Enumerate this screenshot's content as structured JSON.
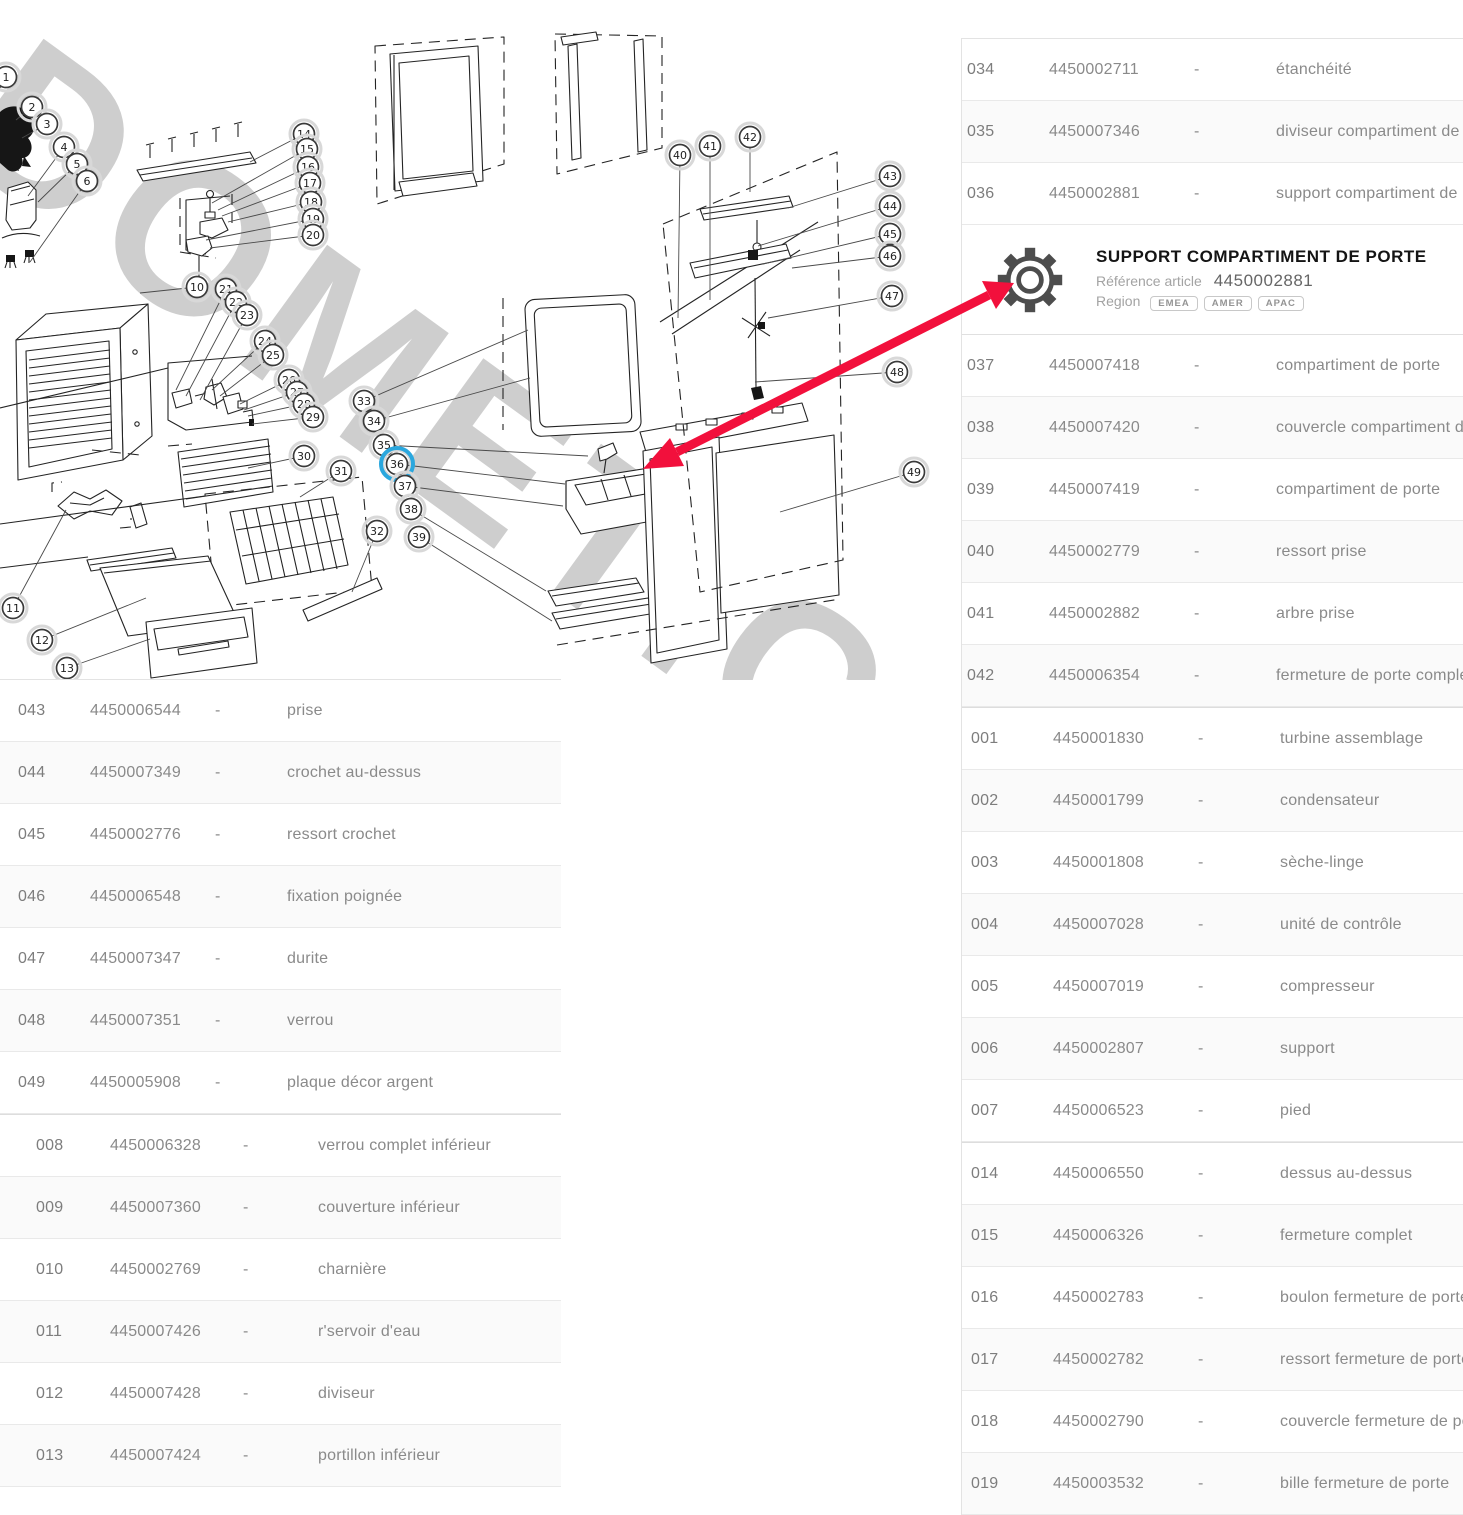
{
  "colors": {
    "arrow_red": "#f2103c",
    "highlight_blue": "#2aa7de",
    "watermark_gray": "#c6c6c6"
  },
  "diagram": {
    "watermark": "DOMETIC",
    "callouts": [
      {
        "n": "1",
        "x": 6,
        "y": 77
      },
      {
        "n": "2",
        "x": 32,
        "y": 107
      },
      {
        "n": "3",
        "x": 47,
        "y": 124
      },
      {
        "n": "4",
        "x": 64,
        "y": 147
      },
      {
        "n": "5",
        "x": 77,
        "y": 164
      },
      {
        "n": "6",
        "x": 87,
        "y": 181
      },
      {
        "n": "10",
        "x": 197,
        "y": 287
      },
      {
        "n": "14",
        "x": 304,
        "y": 134
      },
      {
        "n": "15",
        "x": 307,
        "y": 149
      },
      {
        "n": "16",
        "x": 308,
        "y": 167
      },
      {
        "n": "17",
        "x": 310,
        "y": 183
      },
      {
        "n": "18",
        "x": 311,
        "y": 202
      },
      {
        "n": "19",
        "x": 313,
        "y": 219
      },
      {
        "n": "20",
        "x": 313,
        "y": 235
      },
      {
        "n": "21",
        "x": 226,
        "y": 289
      },
      {
        "n": "22",
        "x": 236,
        "y": 302
      },
      {
        "n": "23",
        "x": 247,
        "y": 315
      },
      {
        "n": "24",
        "x": 265,
        "y": 341
      },
      {
        "n": "25",
        "x": 273,
        "y": 355
      },
      {
        "n": "26",
        "x": 289,
        "y": 380
      },
      {
        "n": "27",
        "x": 297,
        "y": 392
      },
      {
        "n": "28",
        "x": 304,
        "y": 404
      },
      {
        "n": "29",
        "x": 313,
        "y": 417
      },
      {
        "n": "30",
        "x": 304,
        "y": 456
      },
      {
        "n": "31",
        "x": 341,
        "y": 471
      },
      {
        "n": "32",
        "x": 377,
        "y": 531
      },
      {
        "n": "33",
        "x": 364,
        "y": 401
      },
      {
        "n": "34",
        "x": 374,
        "y": 421
      },
      {
        "n": "35",
        "x": 384,
        "y": 445
      },
      {
        "n": "36",
        "x": 397,
        "y": 464,
        "hl": true
      },
      {
        "n": "37",
        "x": 405,
        "y": 486
      },
      {
        "n": "38",
        "x": 411,
        "y": 509
      },
      {
        "n": "39",
        "x": 419,
        "y": 537
      },
      {
        "n": "40",
        "x": 680,
        "y": 155
      },
      {
        "n": "41",
        "x": 710,
        "y": 146
      },
      {
        "n": "42",
        "x": 750,
        "y": 137
      },
      {
        "n": "43",
        "x": 890,
        "y": 176
      },
      {
        "n": "44",
        "x": 890,
        "y": 206
      },
      {
        "n": "45",
        "x": 890,
        "y": 234
      },
      {
        "n": "46",
        "x": 890,
        "y": 256
      },
      {
        "n": "47",
        "x": 892,
        "y": 296
      },
      {
        "n": "48",
        "x": 897,
        "y": 372
      },
      {
        "n": "49",
        "x": 914,
        "y": 472
      },
      {
        "n": "11",
        "x": 13,
        "y": 608
      },
      {
        "n": "12",
        "x": 42,
        "y": 640
      },
      {
        "n": "13",
        "x": 67,
        "y": 668
      }
    ]
  },
  "detail_card": {
    "title": "SUPPORT COMPARTIMENT DE PORTE",
    "reference_label": "Référence article",
    "reference_value": "4450002881",
    "region_label": "Region",
    "regions": [
      {
        "code": "EMEA"
      },
      {
        "code": "AMER"
      },
      {
        "code": "APAC"
      }
    ]
  },
  "left_panel": {
    "group_a": {
      "rows": [
        {
          "n": "043",
          "ref": "4450006544",
          "dash": "-",
          "desc": "prise"
        },
        {
          "n": "044",
          "ref": "4450007349",
          "dash": "-",
          "desc": "crochet au-dessus"
        },
        {
          "n": "045",
          "ref": "4450002776",
          "dash": "-",
          "desc": "ressort crochet"
        },
        {
          "n": "046",
          "ref": "4450006548",
          "dash": "-",
          "desc": "fixation poignée"
        },
        {
          "n": "047",
          "ref": "4450007347",
          "dash": "-",
          "desc": "durite"
        },
        {
          "n": "048",
          "ref": "4450007351",
          "dash": "-",
          "desc": "verrou"
        },
        {
          "n": "049",
          "ref": "4450005908",
          "dash": "-",
          "desc": "plaque décor argent"
        }
      ]
    },
    "group_b": {
      "rows": [
        {
          "n": "008",
          "ref": "4450006328",
          "dash": "-",
          "desc": "verrou complet inférieur"
        },
        {
          "n": "009",
          "ref": "4450007360",
          "dash": "-",
          "desc": "couverture inférieur"
        },
        {
          "n": "010",
          "ref": "4450002769",
          "dash": "-",
          "desc": "charnière"
        },
        {
          "n": "011",
          "ref": "4450007426",
          "dash": "-",
          "desc": "r'servoir d'eau"
        },
        {
          "n": "012",
          "ref": "4450007428",
          "dash": "-",
          "desc": "diviseur"
        },
        {
          "n": "013",
          "ref": "4450007424",
          "dash": "-",
          "desc": "portillon inférieur"
        }
      ]
    }
  },
  "right_panel": {
    "group_a": {
      "rows": [
        {
          "n": "034",
          "ref": "4450002711",
          "dash": "-",
          "desc": "étanchéité"
        },
        {
          "n": "035",
          "ref": "4450007346",
          "dash": "-",
          "desc": "diviseur compartiment de porte"
        },
        {
          "n": "036",
          "ref": "4450002881",
          "dash": "-",
          "desc": "support compartiment de porte"
        }
      ]
    },
    "group_b": {
      "rows": [
        {
          "n": "037",
          "ref": "4450007418",
          "dash": "-",
          "desc": "compartiment de porte"
        },
        {
          "n": "038",
          "ref": "4450007420",
          "dash": "-",
          "desc": "couvercle compartiment de porte"
        },
        {
          "n": "039",
          "ref": "4450007419",
          "dash": "-",
          "desc": "compartiment de porte"
        },
        {
          "n": "040",
          "ref": "4450002779",
          "dash": "-",
          "desc": "ressort prise"
        },
        {
          "n": "041",
          "ref": "4450002882",
          "dash": "-",
          "desc": "arbre prise"
        },
        {
          "n": "042",
          "ref": "4450006354",
          "dash": "-",
          "desc": "fermeture de porte complet"
        }
      ]
    },
    "group_c": {
      "rows": [
        {
          "n": "001",
          "ref": "4450001830",
          "dash": "-",
          "desc": "turbine assemblage"
        },
        {
          "n": "002",
          "ref": "4450001799",
          "dash": "-",
          "desc": "condensateur"
        },
        {
          "n": "003",
          "ref": "4450001808",
          "dash": "-",
          "desc": "sèche-linge"
        },
        {
          "n": "004",
          "ref": "4450007028",
          "dash": "-",
          "desc": "unité de contrôle"
        },
        {
          "n": "005",
          "ref": "4450007019",
          "dash": "-",
          "desc": "compresseur"
        },
        {
          "n": "006",
          "ref": "4450002807",
          "dash": "-",
          "desc": "support"
        },
        {
          "n": "007",
          "ref": "4450006523",
          "dash": "-",
          "desc": "pied"
        }
      ]
    },
    "group_d": {
      "rows": [
        {
          "n": "014",
          "ref": "4450006550",
          "dash": "-",
          "desc": "dessus au-dessus"
        },
        {
          "n": "015",
          "ref": "4450006326",
          "dash": "-",
          "desc": "fermeture complet"
        },
        {
          "n": "016",
          "ref": "4450002783",
          "dash": "-",
          "desc": "boulon fermeture de porte"
        },
        {
          "n": "017",
          "ref": "4450002782",
          "dash": "-",
          "desc": "ressort fermeture de porte"
        },
        {
          "n": "018",
          "ref": "4450002790",
          "dash": "-",
          "desc": "couvercle fermeture de porte"
        },
        {
          "n": "019",
          "ref": "4450003532",
          "dash": "-",
          "desc": "bille fermeture de porte"
        }
      ]
    }
  }
}
